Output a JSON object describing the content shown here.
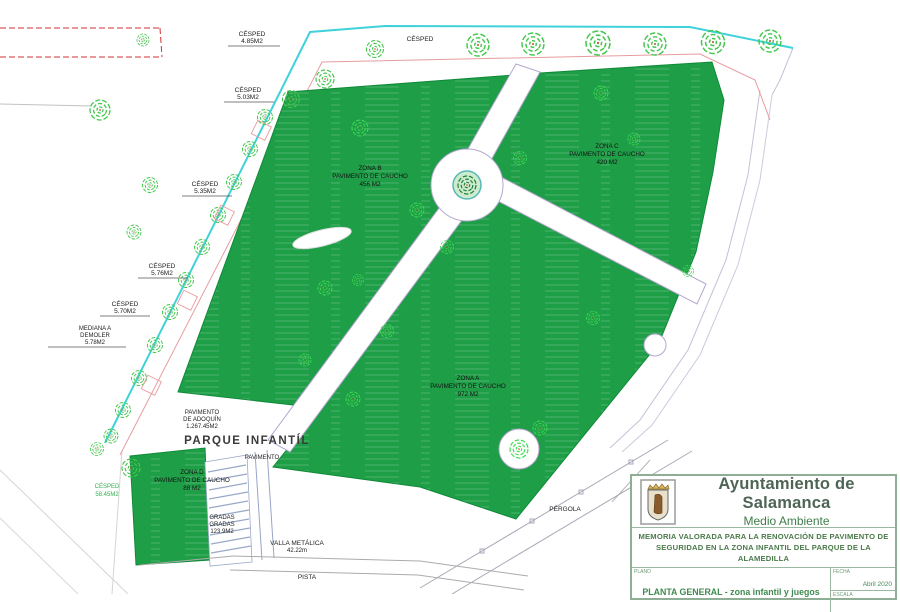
{
  "colors": {
    "zone_green": "#1f9e48",
    "zone_edge": "#0f8a38",
    "tree_green": "#44c74e",
    "tree_bright": "#3fdc52",
    "cyan_line": "#3fd2da",
    "boundary_pink": "#e89ca0",
    "path_edge": "#b3a6cf",
    "red_dashed": "#d03030",
    "title_green": "#3f8a4f"
  },
  "plan": {
    "cesped_top": "CÉSPED",
    "cesped1": {
      "l1": "CÉSPED",
      "l2": "4.85M2"
    },
    "cesped2": {
      "l1": "CÉSPED",
      "l2": "5.03M2"
    },
    "cesped3": {
      "l1": "CÉSPED",
      "l2": "5.35M2"
    },
    "cesped4": {
      "l1": "CÉSPED",
      "l2": "5.76M2"
    },
    "cesped5": {
      "l1": "CÉSPED",
      "l2": "5.70M2"
    },
    "cesped_green": {
      "l1": "CÉSPED",
      "l2": "58.45M2"
    },
    "mediana": {
      "l1": "MEDIANA A",
      "l2": "DEMOLER",
      "l3": "5.78M2"
    },
    "adoquin": {
      "l1": "PAVIMENTO",
      "l2": "DE ADOQUÍN",
      "l3": "1.267.45M2"
    },
    "parque": "PARQUE INFANTÍL",
    "pavimento": "PAVIMENTO",
    "zones": {
      "a": {
        "l1": "ZONA A",
        "l2": "PAVIMENTO DE CAUCHO",
        "l3": "972 M2"
      },
      "b": {
        "l1": "ZONA B",
        "l2": "PAVIMENTO DE CAUCHO",
        "l3": "456 M2"
      },
      "c": {
        "l1": "ZONA C",
        "l2": "PAVIMENTO DE CAUCHO",
        "l3": "420 M2"
      },
      "d": {
        "l1": "ZONA D",
        "l2": "PAVIMENTO DE CAUCHO",
        "l3": "88 M2"
      }
    },
    "gradas": {
      "l1": "GRADAS",
      "l2": "GRADAS",
      "l3": "123.9M2"
    },
    "valla": {
      "l1": "VALLA METÁLICA",
      "l2": "42.22m"
    },
    "pista": "PISTA",
    "pergola": "PÉRGOLA"
  },
  "title_block": {
    "org": "Ayuntamiento de Salamanca",
    "dept": "Medio Ambiente",
    "memoria1": "MEMORIA VALORADA PARA LA RENOVACIÓN DE PAVIMENTO DE",
    "memoria2": "SEGURIDAD EN LA ZONA INFANTIL DEL PARQUE DE LA ALAMEDILLA",
    "plano_label": "PLANO",
    "plano_value": "PLANTA GENERAL - zona infantil y juegos",
    "fecha_label": "FECHA",
    "fecha_value": "Abril 2020",
    "escala_label": "ESCALA",
    "escala_value": ""
  }
}
